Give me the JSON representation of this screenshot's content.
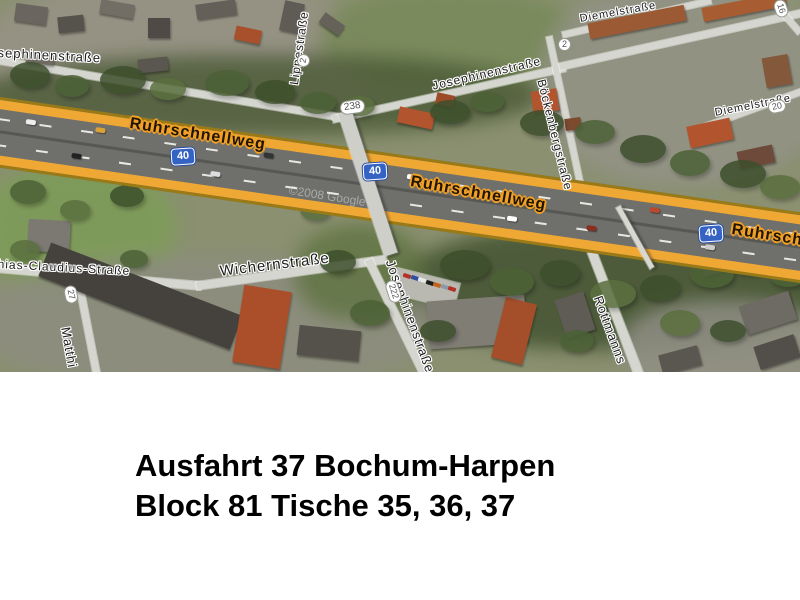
{
  "caption": {
    "line1": "Ausfahrt 37 Bochum-Harpen",
    "line2": "Block 81 Tische 35, 36, 37"
  },
  "map": {
    "watermark": "©2008 Google",
    "highway_name_labels": {
      "west": "Ruhrschnellweg",
      "center": "Ruhrschnellweg",
      "east_clipped": "Ruhrschne"
    },
    "motorway_badges": {
      "west": "40",
      "center": "40",
      "east": "40"
    },
    "street_labels": {
      "josephinen_west_clipped": "sephinenstraße",
      "lippestrasse": "Lippestraße",
      "josephinen_top": "Josephinenstraße",
      "boeckenbergstrasse": "Böckenbergstraße",
      "diemelstrasse_north": "Diemelstraße",
      "diemelstrasse_east": "Diemelstraße",
      "claudius_clipped": "hias-Claudius-Straße",
      "wichernstrasse": "Wichernstraße",
      "josephinen_south": "Josephinenstraße",
      "matthias_clipped": "Matthi",
      "rottmann_clipped": "Rottmanns"
    },
    "small_badges": {
      "route_238": "238",
      "lippe_2": "2",
      "boecken_2": "2",
      "diemel_20": "20",
      "claudius_27": "27",
      "josephinen_222": "222",
      "corner_16": "16"
    },
    "colors": {
      "highway_fill_yellow": "#f0a835",
      "highway_casing": "#9a7a15",
      "highway_label_halo": "#f0a028",
      "motorway_badge_blue": "#3563c4",
      "street_fill": "#d6d6d0",
      "vegetation_dark": "#3d4f2c",
      "grass": "#7fa05c"
    }
  }
}
